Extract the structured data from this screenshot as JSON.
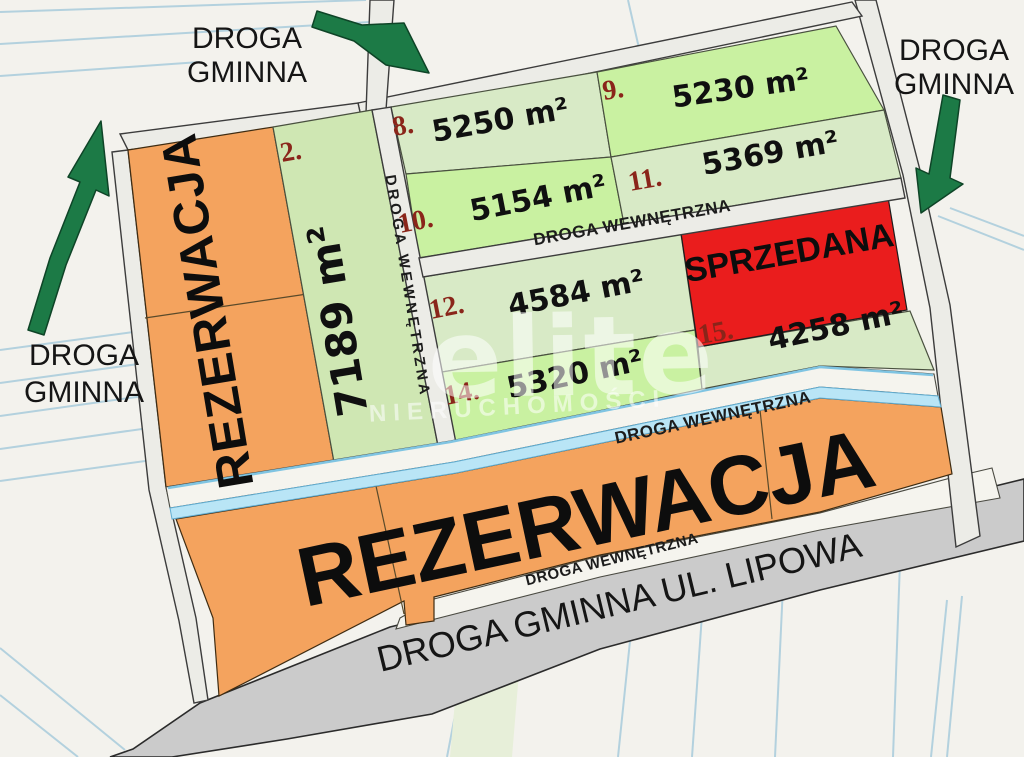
{
  "map_type": "land-parcel-offer-map",
  "colors": {
    "background": "#f3f2ed",
    "parcel_line_blue": "#b3d1de",
    "road_gray": "#ececE7",
    "main_road_gray": "#cbcbcb",
    "plot_green_light": "#d8eac6",
    "plot_green_bright": "#c9f1a1",
    "reserved_orange": "#f4a35e",
    "sold_red": "#ea1d1d",
    "water_channel_blue": "#b9e5f6",
    "arrow_green": "#1c7a46",
    "plot_number_red": "#8a251a"
  },
  "roads": {
    "gminna_line1": "DROGA",
    "gminna_line2": "GMINNA",
    "internal": "DROGA WEWNĘTRZNA",
    "main": "DROGA GMINNA UL. LIPOWA"
  },
  "statuses": {
    "reserved": "REZERWACJA",
    "sold": "SPRZEDANA"
  },
  "plots": {
    "p2": {
      "num": "2.",
      "area": "7189 m²"
    },
    "p8": {
      "num": "8.",
      "area": "5250 m²"
    },
    "p9": {
      "num": "9.",
      "area": "5230 m²"
    },
    "p10": {
      "num": "10.",
      "area": "5154 m²"
    },
    "p11": {
      "num": "11.",
      "area": "5369 m²"
    },
    "p12": {
      "num": "12.",
      "area": "4584 m²"
    },
    "p14": {
      "num": "14.",
      "area": "5320 m²"
    },
    "p15": {
      "num": "15.",
      "area": "4258 m²"
    }
  },
  "watermark": {
    "brand": "elite",
    "subtitle": "NIERUCHOMOŚCI"
  }
}
